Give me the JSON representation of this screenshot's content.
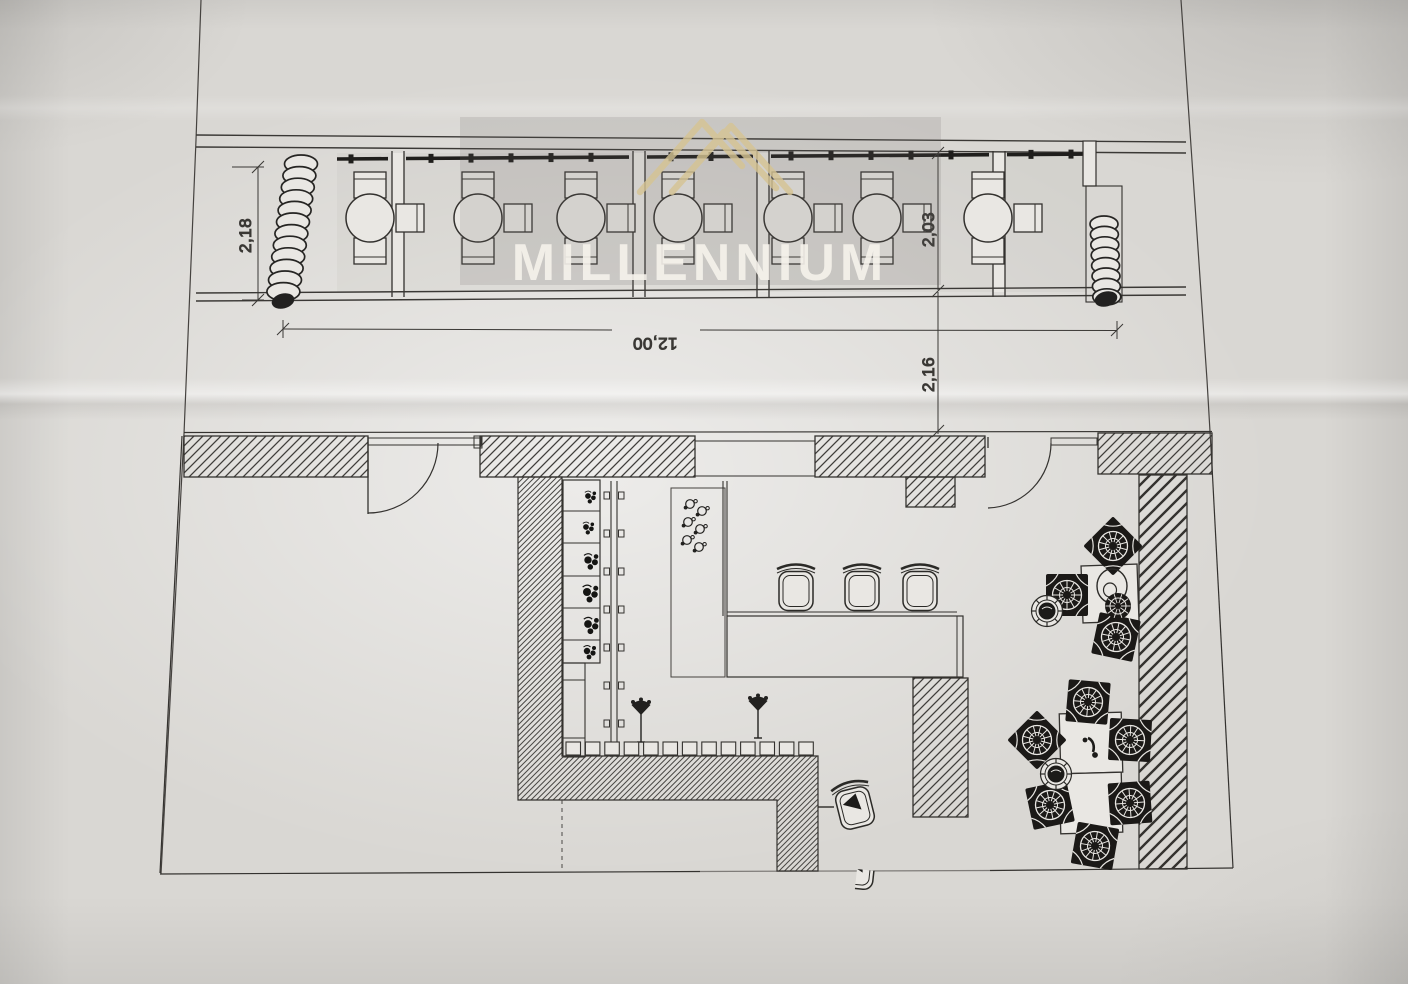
{
  "document": {
    "kind": "photographed architectural floor plan",
    "sheets": [
      "terrace-elevation-strip",
      "interior-floor-plan"
    ]
  },
  "watermark": {
    "text": "MILLENNIUM",
    "logo": "mountain-peaks-logo",
    "logo_color": "#d6c493",
    "box_color": "rgba(105,102,98,0.16)",
    "text_color": "rgba(245,242,235,0.90)"
  },
  "dimensions": {
    "terrace_depth_left": "2,18",
    "terrace_width": "12,00",
    "terrace_depth_right": "2,03",
    "terrace_gap_right": "2,16"
  },
  "plan": {
    "terrace": {
      "table_y": 218,
      "tables": [
        370,
        478,
        581,
        678,
        788,
        877,
        988
      ],
      "dividers": [
        392,
        633,
        757,
        993
      ],
      "awning": {
        "x1": 337,
        "y1": 159,
        "x2": 1086,
        "y2": 154,
        "tick_step": 40
      },
      "coils": [
        {
          "x": 301,
          "y": 164,
          "n": 12,
          "dx": -1.6,
          "dy": 11.6,
          "rx": 16.5,
          "ry": 9,
          "blob": [
            283,
            301
          ]
        },
        {
          "x": 1104,
          "y": 224,
          "n": 8,
          "dx": 0.4,
          "dy": 10.4,
          "rx": 14,
          "ry": 8,
          "blob": [
            1106,
            299
          ]
        }
      ]
    },
    "interior": {
      "counter_stools": [
        {
          "x": 796,
          "y": 591
        },
        {
          "x": 862,
          "y": 591
        },
        {
          "x": 920,
          "y": 591
        }
      ],
      "floor_stools": [
        {
          "x": 855,
          "y": 808,
          "rot": -14
        },
        {
          "x": 857,
          "y": 869,
          "rot": 6,
          "clip": true
        }
      ],
      "wicker_chairs": [
        {
          "x": 1113,
          "y": 546,
          "rot": 45
        },
        {
          "x": 1067,
          "y": 595,
          "rot": 0
        },
        {
          "x": 1116,
          "y": 637,
          "rot": 12
        },
        {
          "x": 1088,
          "y": 702,
          "rot": 5
        },
        {
          "x": 1037,
          "y": 740,
          "rot": 45
        },
        {
          "x": 1050,
          "y": 805,
          "rot": -12
        },
        {
          "x": 1130,
          "y": 740,
          "rot": 3
        },
        {
          "x": 1130,
          "y": 803,
          "rot": -4
        },
        {
          "x": 1095,
          "y": 846,
          "rot": 10
        }
      ],
      "round_stools": [
        {
          "x": 1047,
          "y": 611
        },
        {
          "x": 1056,
          "y": 774
        }
      ],
      "vase": {
        "x": 1112,
        "y": 586
      },
      "plants": [
        {
          "x": 1118,
          "y": 606
        }
      ],
      "lamp": {
        "x": 1091,
        "y": 748
      },
      "taps": [
        {
          "x": 641,
          "y": 712
        },
        {
          "x": 758,
          "y": 708
        }
      ],
      "cups": [
        {
          "x": 690,
          "y": 504
        },
        {
          "x": 702,
          "y": 511
        },
        {
          "x": 688,
          "y": 522
        },
        {
          "x": 700,
          "y": 529
        },
        {
          "x": 687,
          "y": 540
        },
        {
          "x": 699,
          "y": 547
        }
      ],
      "shelf_items": [
        {
          "x": 588,
          "y": 496,
          "s": 0.9
        },
        {
          "x": 586,
          "y": 527,
          "s": 0.9
        },
        {
          "x": 588,
          "y": 560,
          "s": 1.15
        },
        {
          "x": 587,
          "y": 592,
          "s": 1.25
        },
        {
          "x": 588,
          "y": 624,
          "s": 1.2
        },
        {
          "x": 587,
          "y": 651,
          "s": 1.0
        }
      ],
      "counter_tiles": {
        "x0": 566,
        "y": 742,
        "count": 13,
        "step": 19.4,
        "w": 14.5,
        "h": 13
      },
      "bracket_ys": [
        492,
        530,
        568,
        606,
        644,
        682,
        720
      ]
    }
  }
}
